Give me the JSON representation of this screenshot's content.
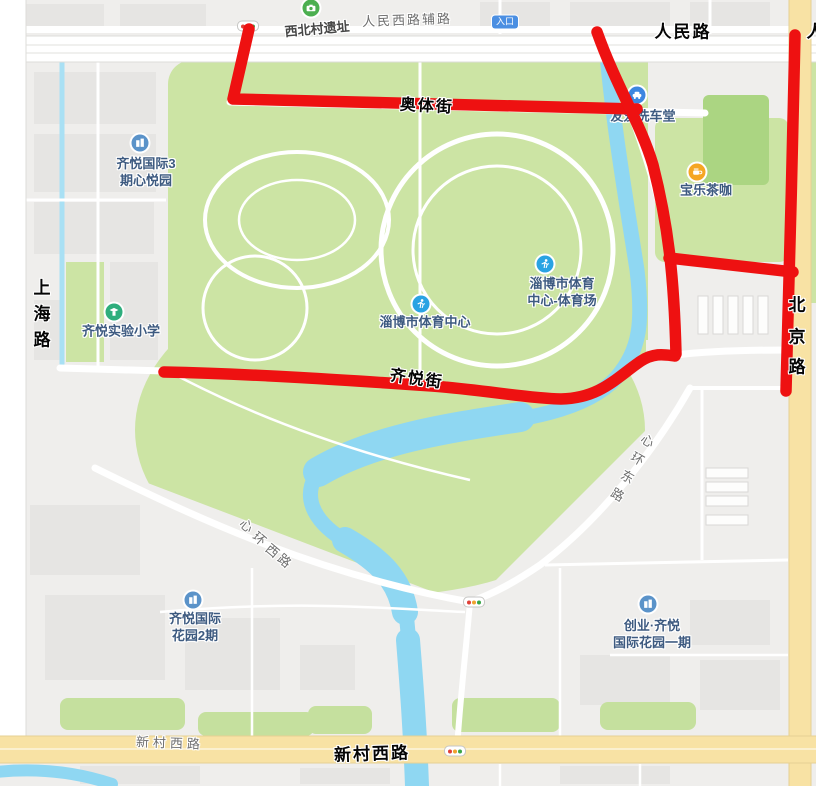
{
  "annotations": {
    "renmin_lu": "人民路",
    "renmin_lu_partial": "人",
    "aoti_jie": "奥体街",
    "qiyue_jie": "齐悦街",
    "xincun_xilu": "新村西路",
    "shanghai_lu": [
      "上",
      "海",
      "路"
    ],
    "beijing_lu": [
      "北",
      "京",
      "路"
    ]
  },
  "map_labels": {
    "renmin_xilu_fulu": "人民西路辅路",
    "xincun_xilu": "新村西路",
    "xinhuan_donglu": [
      "心",
      "环",
      "东",
      "路"
    ],
    "xinhuan_xilu": [
      "心",
      "环",
      "西",
      "路"
    ],
    "entrance_badge": "入口"
  },
  "pois": {
    "xibeicun_site": {
      "label": "西北村遗址"
    },
    "youai_carwash": {
      "label": "友爱洗车堂"
    },
    "baole_cafe": {
      "label": "宝乐茶咖"
    },
    "qiyue_intl_3": {
      "line1": "齐悦国际3",
      "line2": "期心悦园"
    },
    "qiyue_school": {
      "label": "齐悦实验小学"
    },
    "sports_center": {
      "label": "淄博市体育中心"
    },
    "sports_stadium": {
      "line1": "淄博市体育",
      "line2": "中心-体育场"
    },
    "qiyue_garden_2": {
      "line1": "齐悦国际",
      "line2": "花园2期"
    },
    "chuangye_garden": {
      "line1": "创业·齐悦",
      "line2": "国际花园一期"
    }
  },
  "colors": {
    "annotation_red": "#ee1111",
    "road_yellow": "#f8e2a4",
    "park_green": "#cce4a4",
    "river_blue": "#8fd7f2",
    "poi_text_blue": "#3d5a80"
  }
}
